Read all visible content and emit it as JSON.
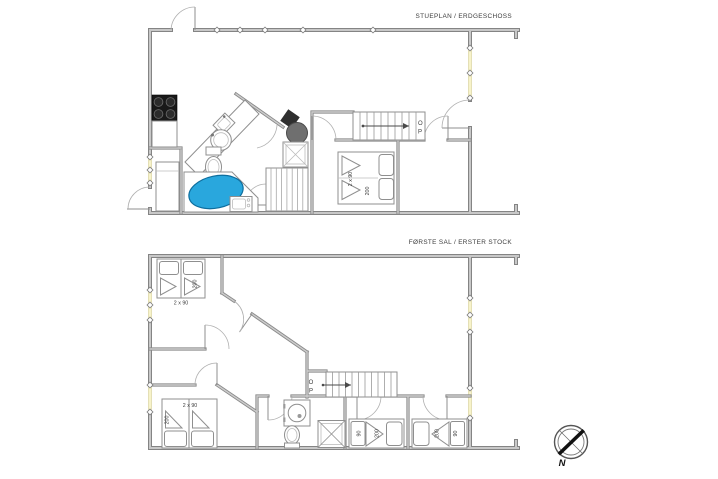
{
  "colors": {
    "wall": "#848484",
    "wall_core": "#c8c8c8",
    "window": "#f7f3c9",
    "bathtub_fill": "#29a7dd",
    "bathtub_edge": "#0e6e9e",
    "stove_black": "#191919",
    "wood_stove_gray": "#6f6f6f",
    "furniture_stroke": "#8f8f8f",
    "text": "#3c3c3c"
  },
  "ground_floor": {
    "title": "STUEPLAN / ERDGESCHOSS",
    "stairs": {
      "label_chars": [
        "O",
        "P"
      ]
    },
    "double_bed": {
      "width_label": "2 x 90",
      "length_label": "200"
    }
  },
  "first_floor": {
    "title": "FØRSTE SAL / ERSTER STOCK",
    "stairs": {
      "label_chars": [
        "O",
        "P"
      ]
    },
    "twin_bed_top_left": {
      "width_label": "2 x 90",
      "length_label": "200"
    },
    "twin_bed_bottom_left": {
      "width_label": "2 x 90",
      "length_label": "200"
    },
    "single_bed_left": {
      "width_label": "90",
      "length_label": "200"
    },
    "single_bed_right": {
      "width_label": "90",
      "length_label": "200"
    }
  },
  "compass": {
    "north_label": "N"
  }
}
